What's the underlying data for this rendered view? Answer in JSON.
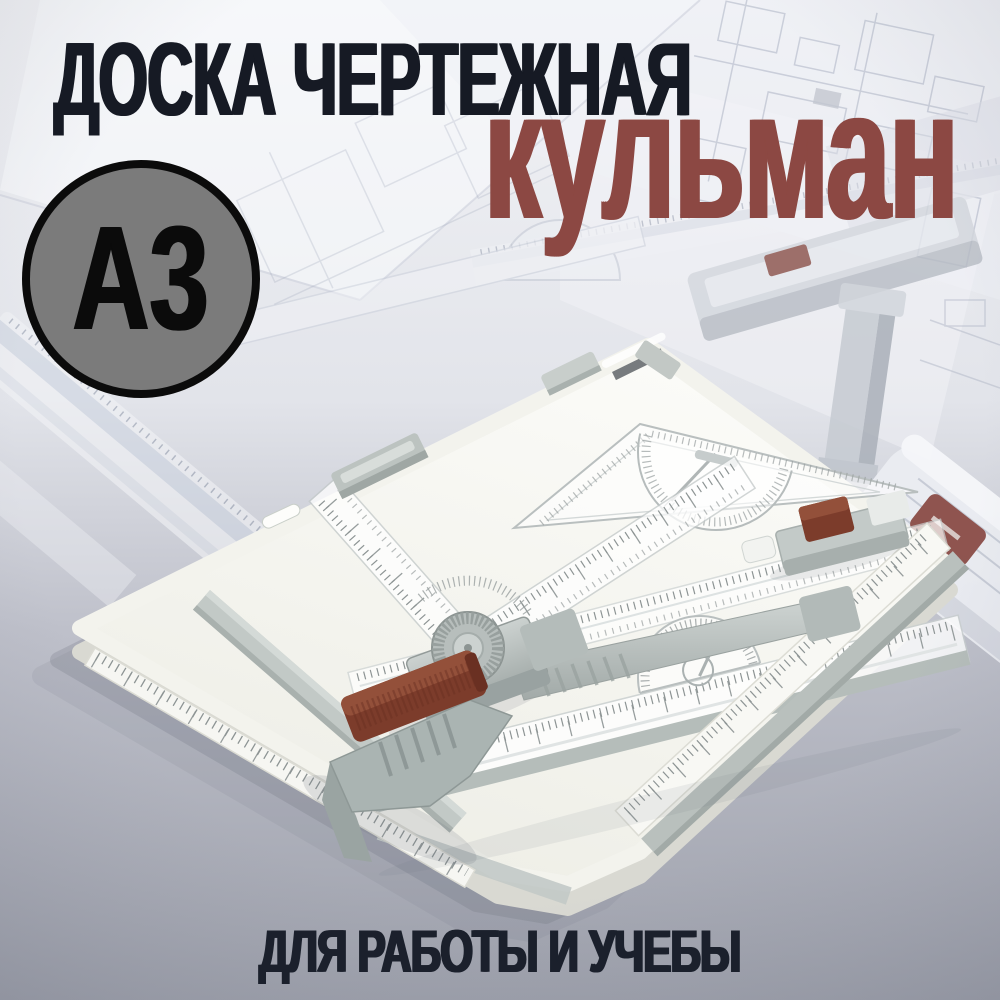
{
  "header": {
    "title": "ДОСКА ЧЕРТЕЖНАЯ",
    "subtitle": "кульман"
  },
  "badge": {
    "size_label": "A3"
  },
  "caption": {
    "text": "ДЛЯ РАБОТЫ И УЧЕБЫ"
  },
  "colors": {
    "title_text": "#161A24",
    "accent_maroon": "#8C4843",
    "badge_fill": "#7B7B7B",
    "badge_border": "#0B0B0B",
    "caption_text": "#1B202C",
    "background_top": "#F2F3F6",
    "background_bottom": "#9DA0AB",
    "board_white": "#F9F9F5",
    "hardware_gray": "#B4BCBA",
    "grip_brown": "#7C3C2B",
    "ruler_tick_gray": "#8D9494"
  }
}
